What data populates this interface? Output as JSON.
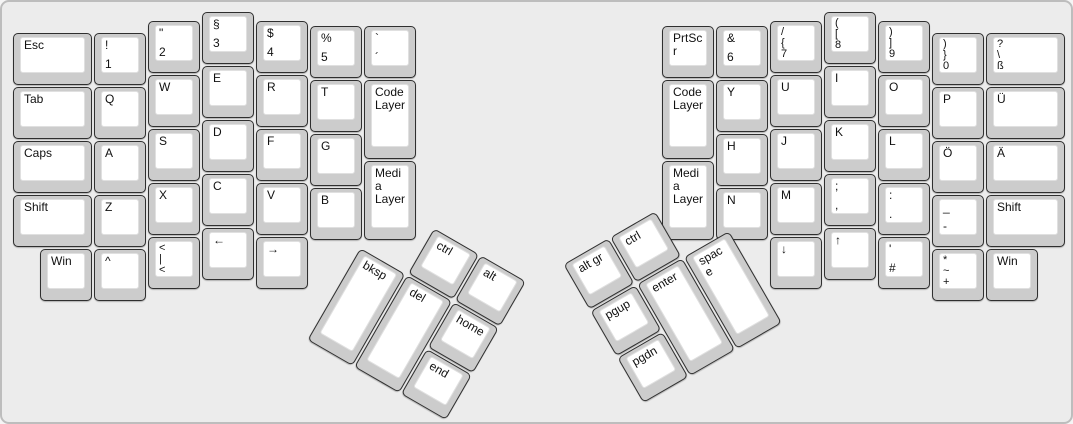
{
  "canvas": {
    "background": "#ececec",
    "border_color": "#bdbdbd"
  },
  "key_style": {
    "cap_side_color": "#cccccc",
    "cap_border_color": "#2f2f2f",
    "surface_color": "#ffffff",
    "surface_border_color": "#e0e0e0",
    "text_color": "#111111"
  },
  "keyboard": {
    "unit_px": 54,
    "groups": [
      {
        "name": "left-main-block",
        "x": 0,
        "y": 0,
        "r": 0,
        "keys": [
          {
            "n": "esc",
            "x": 10,
            "y": 30,
            "w": 81,
            "labels": [
              "Esc"
            ]
          },
          {
            "n": "exclam-1",
            "x": 91,
            "y": 30,
            "labels": [
              "!",
              "1"
            ]
          },
          {
            "n": "quote-2",
            "x": 145,
            "y": 18,
            "labels": [
              "\"",
              "2"
            ]
          },
          {
            "n": "section-3",
            "x": 199,
            "y": 9,
            "labels": [
              "§",
              "3"
            ]
          },
          {
            "n": "dollar-4",
            "x": 253,
            "y": 18,
            "labels": [
              "$",
              "4"
            ]
          },
          {
            "n": "percent-5",
            "x": 307,
            "y": 23,
            "labels": [
              "%",
              "5"
            ]
          },
          {
            "n": "grave-acute",
            "x": 361,
            "y": 23,
            "labels": [
              "`",
              "´"
            ]
          },
          {
            "n": "tab",
            "x": 10,
            "y": 84,
            "w": 81,
            "labels": [
              "Tab"
            ]
          },
          {
            "n": "q",
            "x": 91,
            "y": 84,
            "labels": [
              "Q"
            ]
          },
          {
            "n": "w",
            "x": 145,
            "y": 72,
            "labels": [
              "W"
            ]
          },
          {
            "n": "e",
            "x": 199,
            "y": 63,
            "labels": [
              "E"
            ]
          },
          {
            "n": "r",
            "x": 253,
            "y": 72,
            "labels": [
              "R"
            ]
          },
          {
            "n": "t",
            "x": 307,
            "y": 77,
            "labels": [
              "T"
            ]
          },
          {
            "n": "code-layer-left",
            "x": 361,
            "y": 77,
            "h": 81,
            "labels": [
              "Code Layer"
            ]
          },
          {
            "n": "caps",
            "x": 10,
            "y": 138,
            "w": 81,
            "labels": [
              "Caps"
            ]
          },
          {
            "n": "a",
            "x": 91,
            "y": 138,
            "labels": [
              "A"
            ]
          },
          {
            "n": "s",
            "x": 145,
            "y": 126,
            "labels": [
              "S"
            ]
          },
          {
            "n": "d",
            "x": 199,
            "y": 117,
            "labels": [
              "D"
            ]
          },
          {
            "n": "f",
            "x": 253,
            "y": 126,
            "labels": [
              "F"
            ]
          },
          {
            "n": "g",
            "x": 307,
            "y": 131,
            "labels": [
              "G"
            ]
          },
          {
            "n": "media-layer-left",
            "x": 361,
            "y": 158,
            "h": 81,
            "labels": [
              "Media Layer"
            ]
          },
          {
            "n": "shift-left",
            "x": 10,
            "y": 192,
            "w": 81,
            "labels": [
              "Shift"
            ]
          },
          {
            "n": "z",
            "x": 91,
            "y": 192,
            "labels": [
              "Z"
            ]
          },
          {
            "n": "x",
            "x": 145,
            "y": 180,
            "labels": [
              "X"
            ]
          },
          {
            "n": "c",
            "x": 199,
            "y": 171,
            "labels": [
              "C"
            ]
          },
          {
            "n": "v",
            "x": 253,
            "y": 180,
            "labels": [
              "V"
            ]
          },
          {
            "n": "b",
            "x": 307,
            "y": 185,
            "labels": [
              "B"
            ]
          },
          {
            "n": "win-left",
            "x": 37,
            "y": 246,
            "labels": [
              "Win"
            ]
          },
          {
            "n": "caret",
            "x": 91,
            "y": 246,
            "labels": [
              "^"
            ]
          },
          {
            "n": "angle-pipe",
            "x": 145,
            "y": 234,
            "labels": [
              "<",
              "|",
              "<"
            ]
          },
          {
            "n": "arrow-left",
            "x": 199,
            "y": 225,
            "labels": [
              "←"
            ]
          },
          {
            "n": "arrow-right",
            "x": 253,
            "y": 234,
            "labels": [
              "→"
            ]
          }
        ]
      },
      {
        "name": "left-thumb-cluster",
        "x": 385,
        "y": 198,
        "r": 30,
        "keys": [
          {
            "n": "ctrl-left",
            "x": 54,
            "y": 0,
            "labels": [
              "ctrl"
            ]
          },
          {
            "n": "alt",
            "x": 108,
            "y": 0,
            "labels": [
              "alt"
            ]
          },
          {
            "n": "bksp",
            "x": 0,
            "y": 54,
            "h": 108,
            "labels": [
              "bksp"
            ]
          },
          {
            "n": "del",
            "x": 54,
            "y": 54,
            "h": 108,
            "labels": [
              "del"
            ]
          },
          {
            "n": "home",
            "x": 108,
            "y": 54,
            "labels": [
              "home"
            ]
          },
          {
            "n": "end",
            "x": 108,
            "y": 108,
            "labels": [
              "end"
            ]
          }
        ]
      },
      {
        "name": "right-main-block",
        "x": 0,
        "y": 0,
        "r": 0,
        "keys": [
          {
            "n": "prtscr",
            "x": 659,
            "y": 23,
            "labels": [
              "PrtScr"
            ]
          },
          {
            "n": "amp-6",
            "x": 713,
            "y": 23,
            "labels": [
              "&",
              "6"
            ]
          },
          {
            "n": "slash-7",
            "x": 767,
            "y": 18,
            "labels": [
              "/",
              "{",
              "7"
            ]
          },
          {
            "n": "paren-8",
            "x": 821,
            "y": 9,
            "labels": [
              "(",
              "[",
              "8"
            ]
          },
          {
            "n": "paren-9",
            "x": 875,
            "y": 18,
            "labels": [
              ")",
              "]",
              "9"
            ]
          },
          {
            "n": "paren-0",
            "x": 929,
            "y": 30,
            "labels": [
              ")",
              "}",
              "0"
            ]
          },
          {
            "n": "question-eszett",
            "x": 983,
            "y": 30,
            "w": 81,
            "labels": [
              "?",
              "\\",
              "ß"
            ]
          },
          {
            "n": "code-layer-right",
            "x": 659,
            "y": 77,
            "h": 81,
            "labels": [
              "Code Layer"
            ]
          },
          {
            "n": "y",
            "x": 713,
            "y": 77,
            "labels": [
              "Y"
            ]
          },
          {
            "n": "u",
            "x": 767,
            "y": 72,
            "labels": [
              "U"
            ]
          },
          {
            "n": "i",
            "x": 821,
            "y": 63,
            "labels": [
              "I"
            ]
          },
          {
            "n": "o",
            "x": 875,
            "y": 72,
            "labels": [
              "O"
            ]
          },
          {
            "n": "p",
            "x": 929,
            "y": 84,
            "labels": [
              "P"
            ]
          },
          {
            "n": "u-umlaut",
            "x": 983,
            "y": 84,
            "w": 81,
            "labels": [
              "Ü"
            ]
          },
          {
            "n": "media-layer-right",
            "x": 659,
            "y": 158,
            "h": 81,
            "labels": [
              "Media Layer"
            ]
          },
          {
            "n": "h",
            "x": 713,
            "y": 131,
            "labels": [
              "H"
            ]
          },
          {
            "n": "j",
            "x": 767,
            "y": 126,
            "labels": [
              "J"
            ]
          },
          {
            "n": "k",
            "x": 821,
            "y": 117,
            "labels": [
              "K"
            ]
          },
          {
            "n": "l",
            "x": 875,
            "y": 126,
            "labels": [
              "L"
            ]
          },
          {
            "n": "o-umlaut",
            "x": 929,
            "y": 138,
            "labels": [
              "Ö"
            ]
          },
          {
            "n": "a-umlaut",
            "x": 983,
            "y": 138,
            "w": 81,
            "labels": [
              "Ä"
            ]
          },
          {
            "n": "n",
            "x": 713,
            "y": 185,
            "labels": [
              "N"
            ]
          },
          {
            "n": "m",
            "x": 767,
            "y": 180,
            "labels": [
              "M"
            ]
          },
          {
            "n": "semicolon-comma",
            "x": 821,
            "y": 171,
            "labels": [
              ";",
              ","
            ]
          },
          {
            "n": "colon-period",
            "x": 875,
            "y": 180,
            "labels": [
              ":",
              "."
            ]
          },
          {
            "n": "underscore-hyphen",
            "x": 929,
            "y": 192,
            "labels": [
              "_",
              "-"
            ]
          },
          {
            "n": "shift-right",
            "x": 983,
            "y": 192,
            "w": 81,
            "labels": [
              "Shift"
            ]
          },
          {
            "n": "arrow-down",
            "x": 767,
            "y": 234,
            "labels": [
              "↓"
            ]
          },
          {
            "n": "arrow-up",
            "x": 821,
            "y": 225,
            "labels": [
              "↑"
            ]
          },
          {
            "n": "apostrophe-hash",
            "x": 875,
            "y": 234,
            "labels": [
              "'",
              "#"
            ]
          },
          {
            "n": "star-tilde-plus",
            "x": 929,
            "y": 246,
            "labels": [
              "*",
              "~",
              "+"
            ]
          },
          {
            "n": "win-right",
            "x": 983,
            "y": 246,
            "labels": [
              "Win"
            ]
          }
        ]
      },
      {
        "name": "right-thumb-cluster",
        "x": 560,
        "y": 262,
        "r": -30,
        "keys": [
          {
            "n": "altgr",
            "x": 0,
            "y": 0,
            "labels": [
              "alt gr"
            ]
          },
          {
            "n": "ctrl-right",
            "x": 54,
            "y": 0,
            "labels": [
              "ctrl"
            ]
          },
          {
            "n": "pgup",
            "x": 0,
            "y": 54,
            "labels": [
              "pgup"
            ]
          },
          {
            "n": "enter",
            "x": 54,
            "y": 54,
            "h": 108,
            "labels": [
              "enter"
            ]
          },
          {
            "n": "space",
            "x": 108,
            "y": 54,
            "h": 108,
            "labels": [
              "space"
            ]
          },
          {
            "n": "pgdn",
            "x": 0,
            "y": 108,
            "labels": [
              "pgdn"
            ]
          }
        ]
      }
    ]
  }
}
